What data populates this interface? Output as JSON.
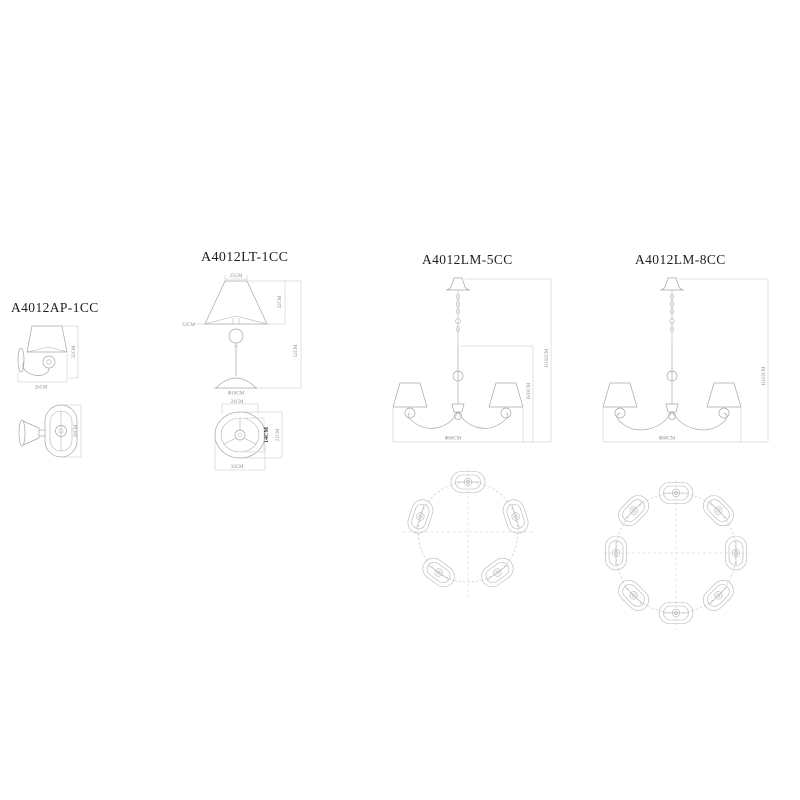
{
  "page": {
    "background": "#ffffff"
  },
  "products": {
    "wall": {
      "code": "A4012AP-1CC",
      "front": {
        "width_label": "26CM",
        "height_label": "32CM"
      },
      "side": {
        "depth_label": "20CM"
      }
    },
    "table": {
      "code": "A4012LT-1CC",
      "front": {
        "shade_top_label": "25CM",
        "shade_height_label": "22CM",
        "shade_bottom_label": "32CM",
        "total_height_label": "52CM",
        "base_label": "Φ18CM"
      },
      "plan": {
        "top_label": "24CM",
        "hub_label": "14CM",
        "side_label": "21CM",
        "bottom_label": "33CM"
      }
    },
    "chandelier5": {
      "code": "A4012LM-5CC",
      "front": {
        "body_height_label": "H43CM",
        "max_height_label": "H102CM",
        "diameter_label": "Φ66CM"
      },
      "plan": {
        "lights": "5"
      }
    },
    "chandelier8": {
      "code": "A4012LM-8CC",
      "front": {
        "max_height_label": "H102CM",
        "diameter_label": "Φ80CM"
      },
      "plan": {
        "lights": "8"
      }
    }
  }
}
